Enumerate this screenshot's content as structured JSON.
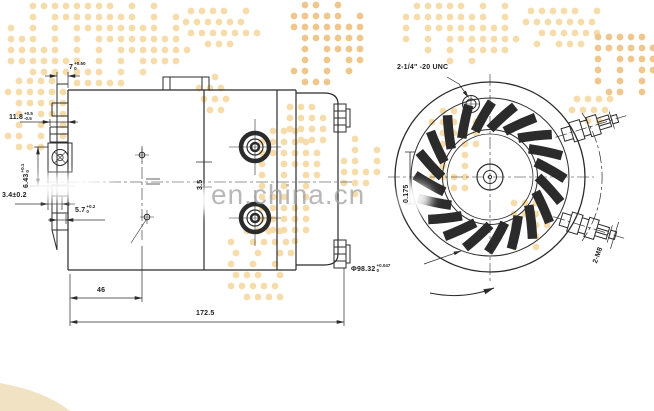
{
  "watermark": "en.china.cn",
  "dims": {
    "d7": {
      "v": "7",
      "up": "+0.50",
      "dn": "0"
    },
    "d11_8": {
      "v": "11.8",
      "up": "+0.5",
      "dn": "-0.5"
    },
    "d6_43": {
      "v": "6.43",
      "up": "+0.1",
      "dn": "0"
    },
    "d3_4": {
      "v": "3.4±0.2"
    },
    "d5_7": {
      "v": "5.7",
      "up": "+0.2",
      "dn": "0"
    },
    "d3_5": {
      "v": "3.5"
    },
    "d46": {
      "v": "46"
    },
    "d172_5": {
      "v": "172.5"
    },
    "d0_175": {
      "v": "0.175"
    },
    "thread_note": {
      "v": "2-1/4\" -20 UNC"
    },
    "dia98": {
      "v": "Φ98.32",
      "up": "+0.047",
      "dn": "0"
    },
    "port_note": {
      "v": "2-M8"
    }
  },
  "colors": {
    "line": "#2b2b2b",
    "dot": "#f6dcab",
    "dot_dark": "#efc78d",
    "watermark_text": "#9e9e9e",
    "paper": "#ffffff"
  }
}
